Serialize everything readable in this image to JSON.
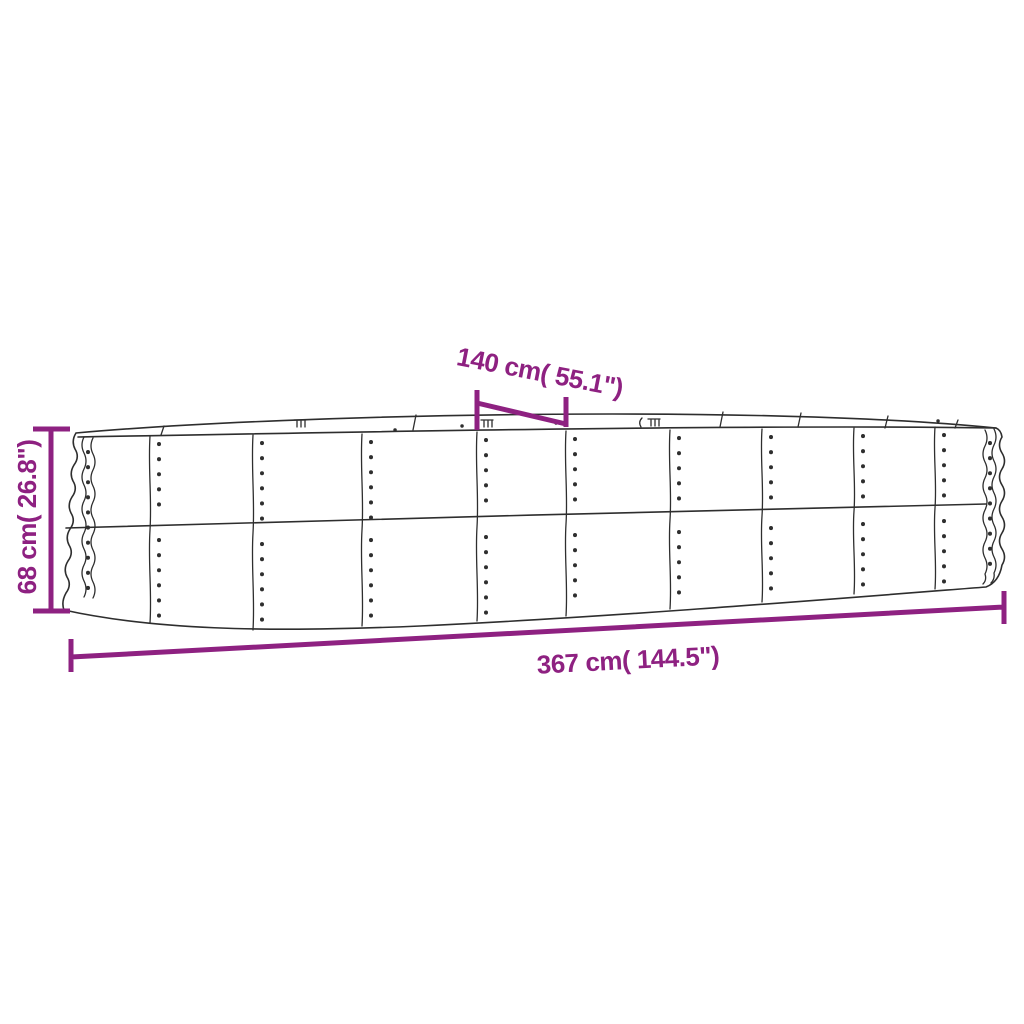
{
  "page": {
    "background_color": "#ffffff",
    "kind": "product dimension diagram",
    "subject": "oval corrugated-metal raised garden bed planter, outline line drawing with riveted panel seams"
  },
  "colors": {
    "dimension_accent": "#8E2181",
    "line_art": "#2e2e2e"
  },
  "dimensions": {
    "width": {
      "label": "140 cm( 55.1\")",
      "cm": 140,
      "inches": 55.1,
      "position": "top, diagonal callout over rear rim"
    },
    "height": {
      "label": "68 cm( 26.8\")",
      "cm": 68,
      "inches": 26.8,
      "position": "left, vertical"
    },
    "length": {
      "label": "367 cm( 144.5\")",
      "cm": 367,
      "inches": 144.5,
      "position": "bottom, full span"
    }
  }
}
